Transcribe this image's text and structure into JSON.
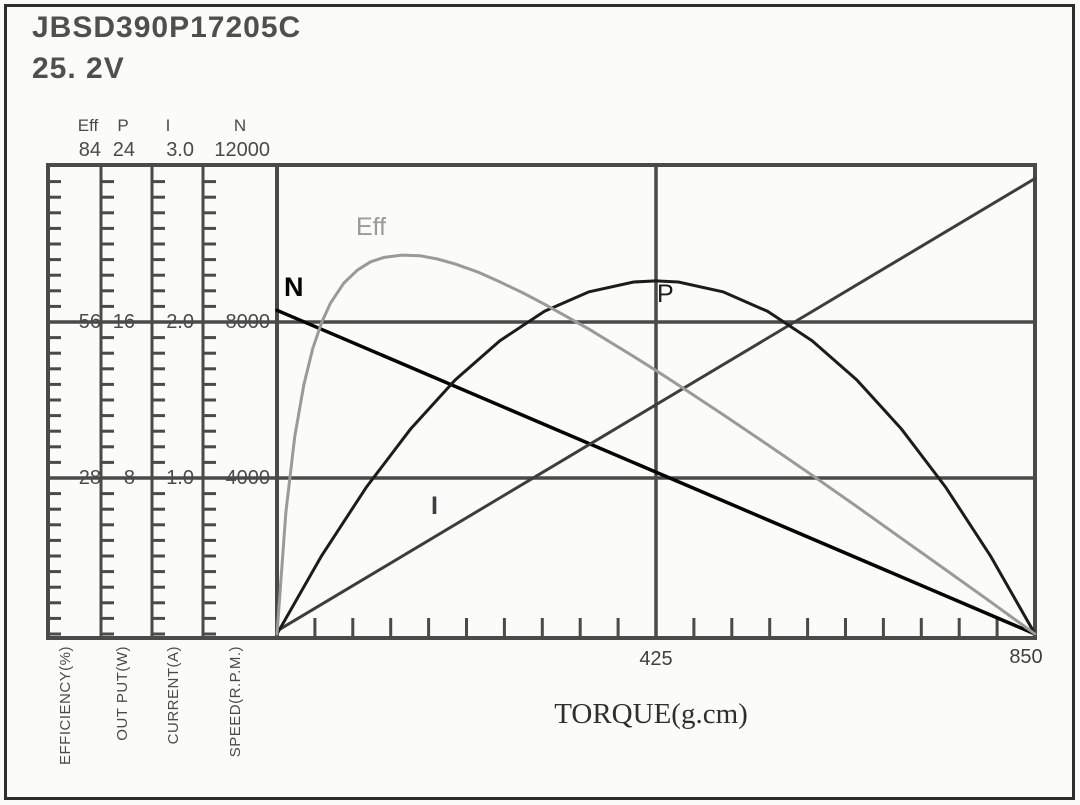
{
  "header": {
    "model": "JBSD390P17205C",
    "voltage": "25. 2V"
  },
  "chart_data": {
    "type": "line",
    "xlabel": "TORQUE(g.cm)",
    "x_range": [
      0,
      850
    ],
    "x_major_ticks": [
      425,
      850
    ],
    "x_tick_labels": [
      "425",
      "850"
    ],
    "x_minor_step": 42.5,
    "grid": "major",
    "legend_position": "inline-curve-labels",
    "frame_color": "#4a4a4a",
    "axes": [
      {
        "id": "eff",
        "name": "Eff",
        "caption": "EFFICIENCY(%)",
        "max": 84,
        "tick_labels": [
          "84",
          "56",
          "28"
        ],
        "tick_values": [
          84,
          56,
          28
        ],
        "minor_step": 2.8
      },
      {
        "id": "p",
        "name": "P",
        "caption": "OUT  PUT(W)",
        "max": 24,
        "tick_labels": [
          "24",
          "16",
          "8"
        ],
        "tick_values": [
          24,
          16,
          8
        ],
        "minor_step": 0.8
      },
      {
        "id": "i",
        "name": "I",
        "caption": "CURRENT(A)",
        "max": 3.0,
        "tick_labels": [
          "3.0",
          "2.0",
          "1.0"
        ],
        "tick_values": [
          3.0,
          2.0,
          1.0
        ],
        "minor_step": 0.1
      },
      {
        "id": "n",
        "name": "N",
        "caption": "SPEED(R.P.M.)",
        "max": 12000,
        "tick_labels": [
          "12000",
          "8000",
          "4000"
        ],
        "tick_values": [
          12000,
          8000,
          4000
        ],
        "minor_step": 400
      }
    ],
    "series": [
      {
        "name": "N",
        "axis": "n",
        "color": "#050505",
        "label_pos": [
          284,
          272
        ],
        "bold_label": true,
        "points": [
          [
            0,
            8300
          ],
          [
            850,
            0
          ]
        ]
      },
      {
        "name": "I",
        "axis": "i",
        "color": "#3d3d3d",
        "label_pos": [
          431,
          492
        ],
        "bold_label": true,
        "points": [
          [
            0,
            0.02
          ],
          [
            850,
            2.92
          ]
        ]
      },
      {
        "name": "P",
        "axis": "p",
        "color": "#1c1c1c",
        "label_pos": [
          657,
          280
        ],
        "bold_label": false,
        "points": [
          [
            0,
            0
          ],
          [
            50,
            4.01
          ],
          [
            100,
            7.52
          ],
          [
            150,
            10.53
          ],
          [
            200,
            13.04
          ],
          [
            250,
            15.04
          ],
          [
            300,
            16.55
          ],
          [
            350,
            17.55
          ],
          [
            400,
            18.05
          ],
          [
            425,
            18.11
          ],
          [
            450,
            18.05
          ],
          [
            500,
            17.55
          ],
          [
            550,
            16.55
          ],
          [
            600,
            15.04
          ],
          [
            650,
            13.04
          ],
          [
            700,
            10.53
          ],
          [
            750,
            7.52
          ],
          [
            800,
            4.01
          ],
          [
            850,
            0
          ]
        ]
      },
      {
        "name": "Eff",
        "axis": "eff",
        "color": "#9a9a9a",
        "label_pos": [
          356,
          213
        ],
        "bold_label": false,
        "points": [
          [
            0,
            0
          ],
          [
            10,
            21.9
          ],
          [
            20,
            35.5
          ],
          [
            30,
            44.7
          ],
          [
            40,
            51.2
          ],
          [
            50,
            55.9
          ],
          [
            60,
            59.4
          ],
          [
            75,
            63.0
          ],
          [
            90,
            65.3
          ],
          [
            105,
            66.8
          ],
          [
            120,
            67.6
          ],
          [
            140,
            68.0
          ],
          [
            160,
            67.9
          ],
          [
            180,
            67.3
          ],
          [
            200,
            66.4
          ],
          [
            225,
            65.0
          ],
          [
            250,
            63.2
          ],
          [
            275,
            61.3
          ],
          [
            300,
            59.2
          ],
          [
            350,
            54.7
          ],
          [
            400,
            49.8
          ],
          [
            425,
            47.3
          ],
          [
            450,
            44.7
          ],
          [
            500,
            39.4
          ],
          [
            550,
            34.0
          ],
          [
            600,
            28.5
          ],
          [
            650,
            22.9
          ],
          [
            700,
            17.2
          ],
          [
            750,
            11.5
          ],
          [
            800,
            5.8
          ],
          [
            850,
            0
          ]
        ]
      }
    ]
  }
}
